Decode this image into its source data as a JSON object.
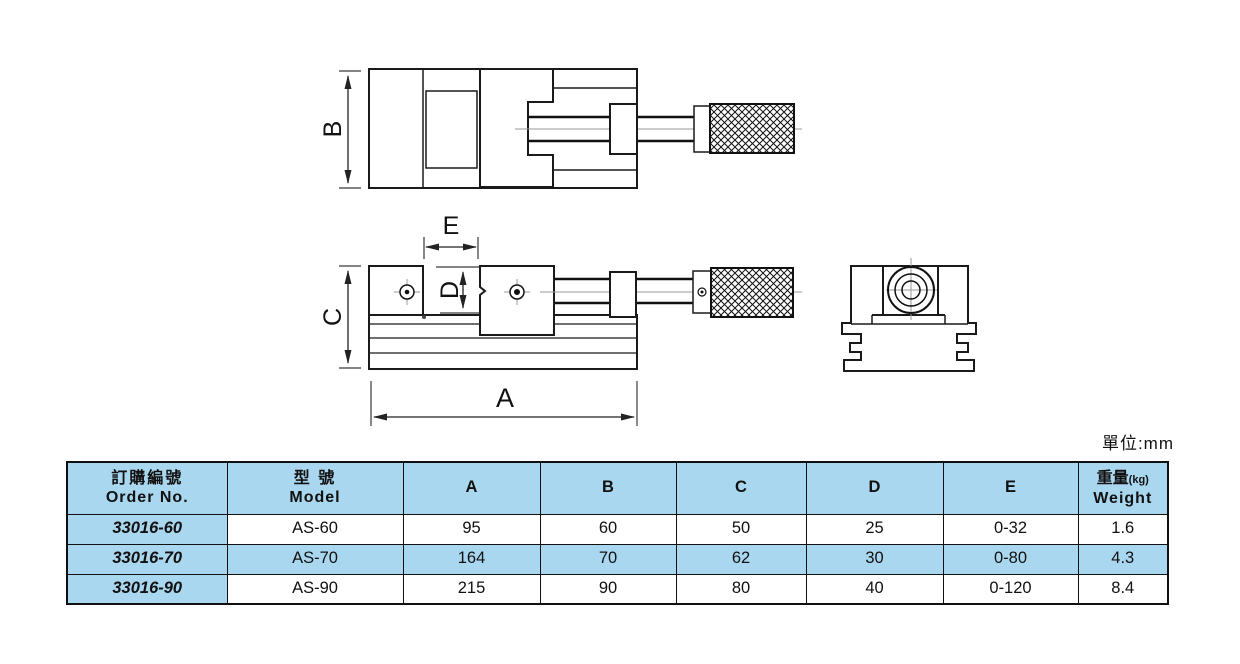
{
  "unit_label": "單位:mm",
  "drawing": {
    "dims": {
      "a": "A",
      "b": "B",
      "c": "C",
      "d": "D",
      "e": "E"
    }
  },
  "table": {
    "headers": {
      "order_no": {
        "zh": "訂購編號",
        "en": "Order No."
      },
      "model": {
        "zh": "型 號",
        "en": "Model"
      },
      "a": "A",
      "b": "B",
      "c": "C",
      "d": "D",
      "e": "E",
      "weight": {
        "zh": "重量",
        "unit": "(kg)",
        "en": "Weight"
      }
    },
    "rows": [
      {
        "order_no": "33016-60",
        "model": "AS-60",
        "a": "95",
        "b": "60",
        "c": "50",
        "d": "25",
        "e": "0-32",
        "weight": "1.6"
      },
      {
        "order_no": "33016-70",
        "model": "AS-70",
        "a": "164",
        "b": "70",
        "c": "62",
        "d": "30",
        "e": "0-80",
        "weight": "4.3"
      },
      {
        "order_no": "33016-90",
        "model": "AS-90",
        "a": "215",
        "b": "90",
        "c": "80",
        "d": "40",
        "e": "0-120",
        "weight": "8.4"
      }
    ]
  },
  "colors": {
    "table_blue": "#a9d7ef",
    "line": "#111111"
  }
}
